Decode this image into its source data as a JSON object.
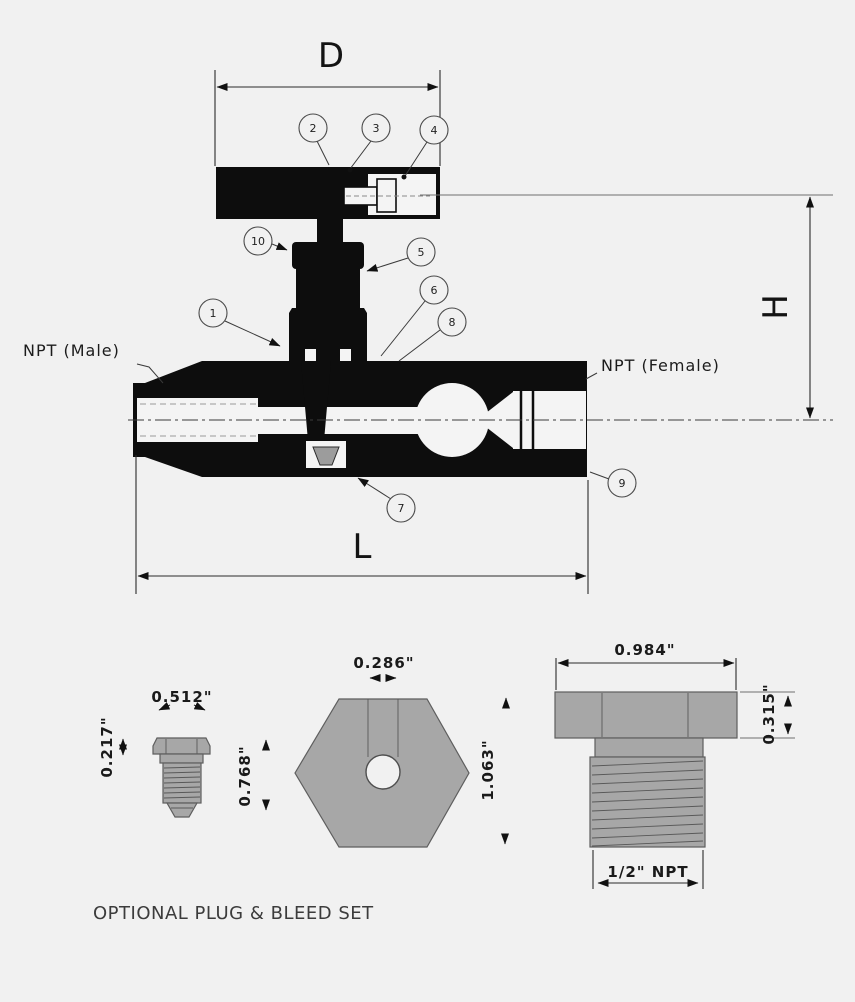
{
  "diagram": {
    "dims": {
      "width": "D",
      "height": "H",
      "length": "L"
    },
    "ports": {
      "male": "NPT (Male)",
      "female": "NPT (Female)"
    },
    "callouts": {
      "c1": "1",
      "c2": "2",
      "c3": "3",
      "c4": "4",
      "c5": "5",
      "c6": "6",
      "c7": "7",
      "c8": "8",
      "c9": "9",
      "c10": "10"
    }
  },
  "parts": {
    "caption": "OPTIONAL PLUG & BLEED SET",
    "bleed_screw": {
      "width": "0.512\"",
      "tip_len": "0.217\"",
      "length": "0.768\""
    },
    "plug_end_view": {
      "hole_dia": "0.286\"",
      "across_flats": "1.063\""
    },
    "plug_side_view": {
      "hex_width": "0.984\"",
      "hex_height": "0.315\"",
      "thread": "1/2\" NPT"
    }
  },
  "colors": {
    "background": "#f1f1f1",
    "ink": "#0d0d0d",
    "metal_gray": "#a7a7a7",
    "dim_line": "#2a2a2a"
  }
}
